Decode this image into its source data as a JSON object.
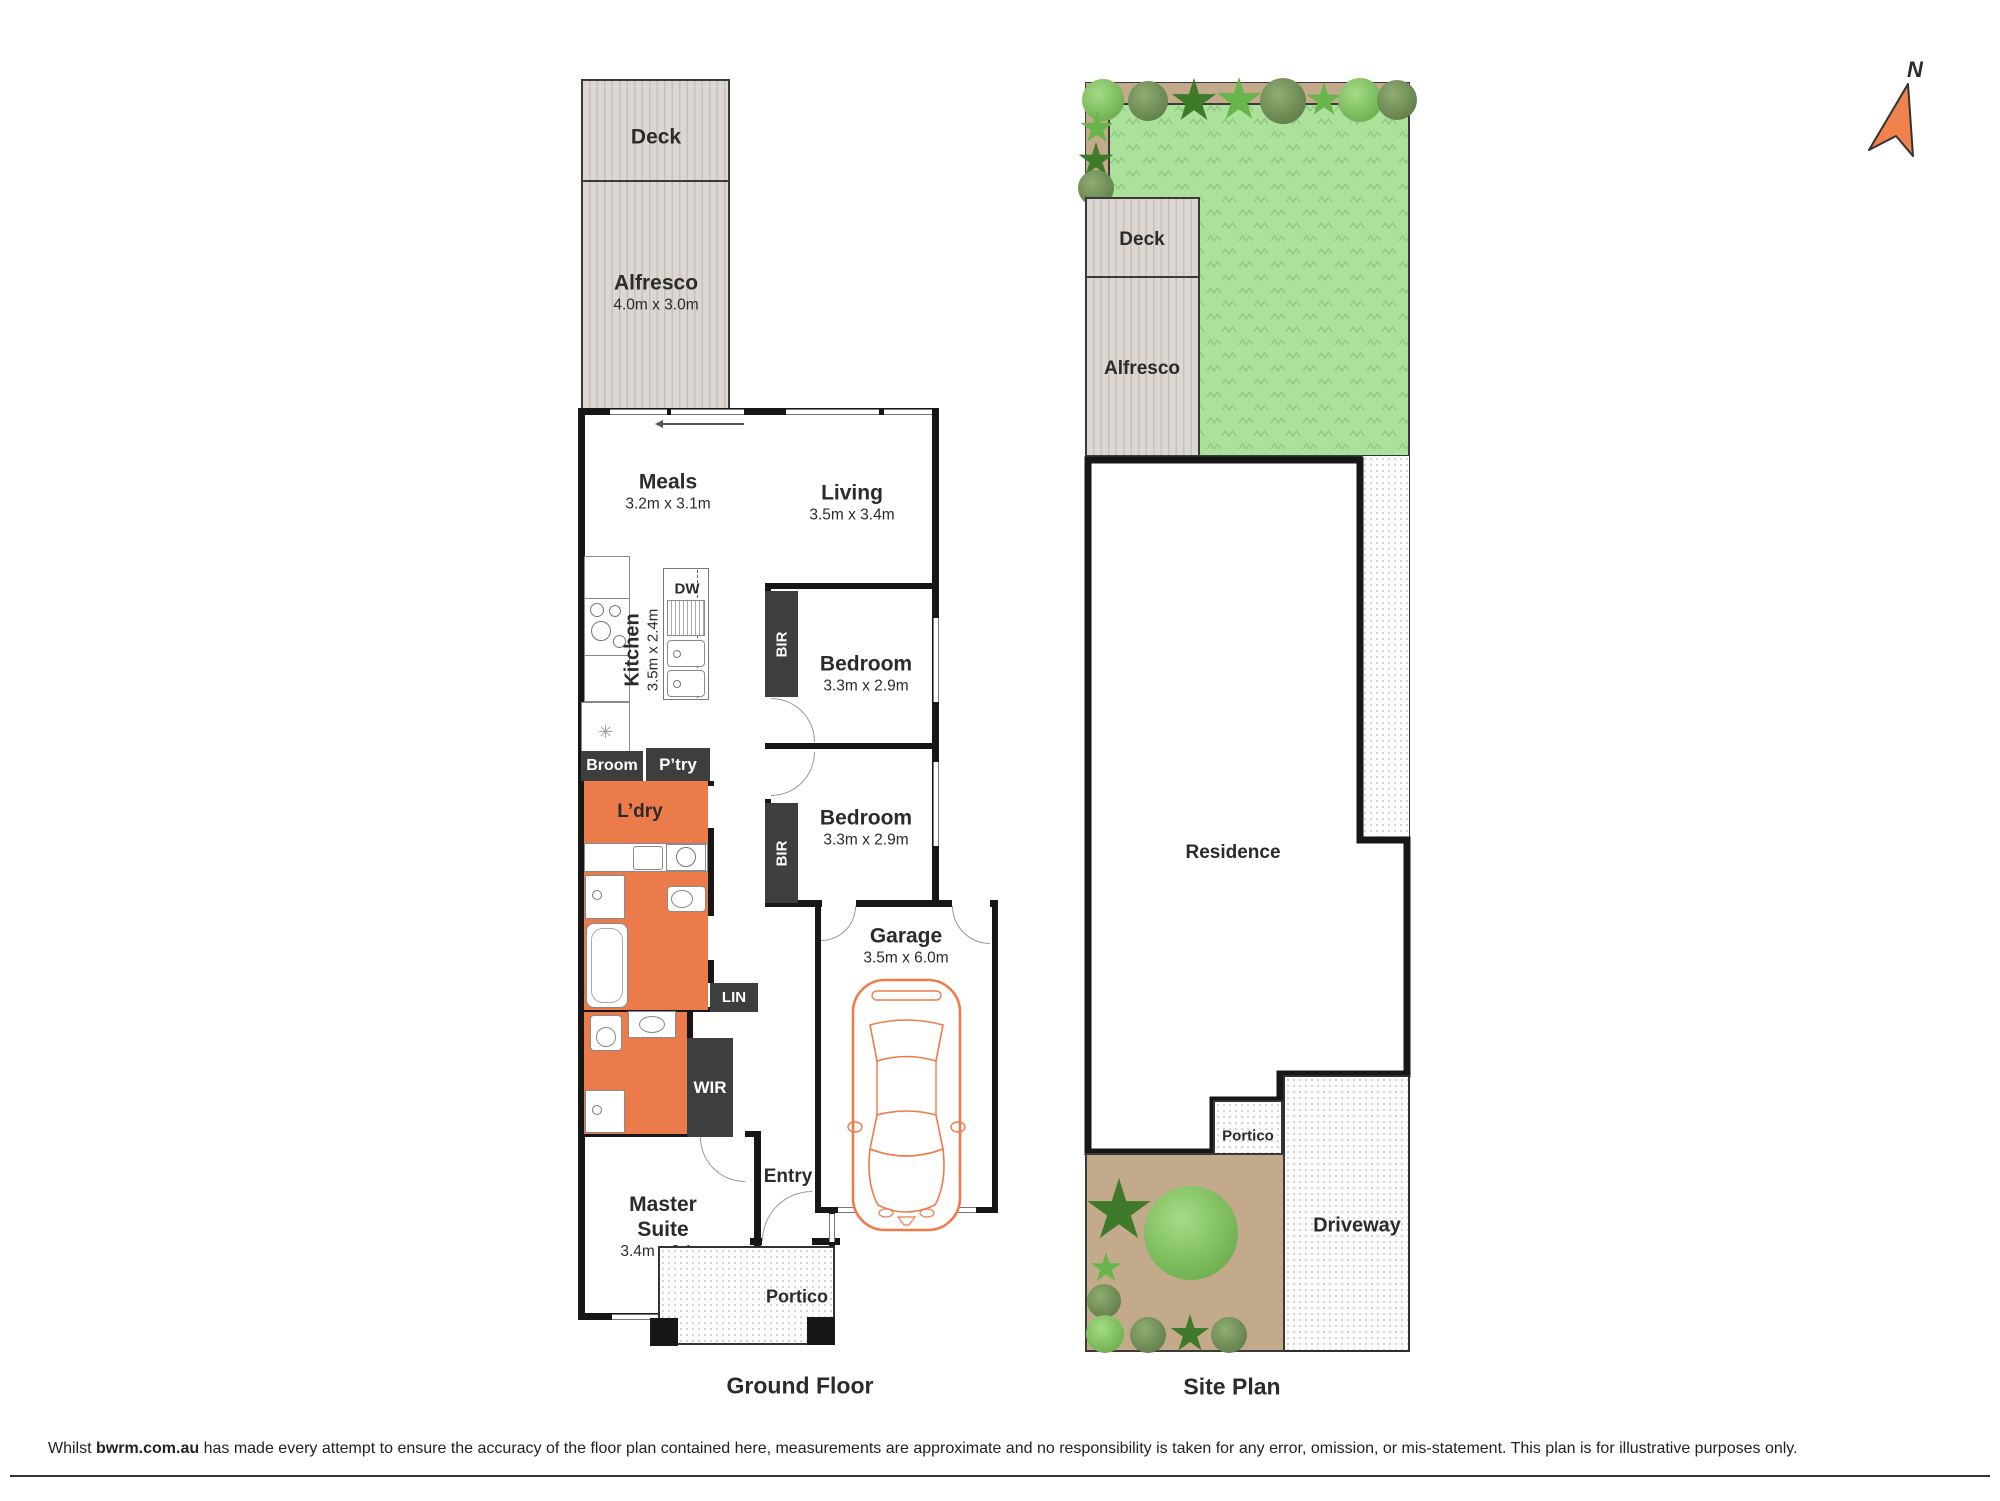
{
  "compass": {
    "label": "N"
  },
  "ground_floor": {
    "caption": "Ground Floor",
    "deck": {
      "label": "Deck"
    },
    "alfresco": {
      "label": "Alfresco",
      "dims": "4.0m x 3.0m"
    },
    "meals": {
      "label": "Meals",
      "dims": "3.2m x 3.1m"
    },
    "living": {
      "label": "Living",
      "dims": "3.5m x 3.4m"
    },
    "kitchen": {
      "label": "Kitchen",
      "dims": "3.5m x 2.4m"
    },
    "dishwasher": "DW",
    "bedroom1": {
      "label": "Bedroom",
      "dims": "3.3m x 2.9m",
      "robe": "BIR"
    },
    "bedroom2": {
      "label": "Bedroom",
      "dims": "3.3m x 2.9m",
      "robe": "BIR"
    },
    "broom": "Broom",
    "pantry": "P’try",
    "laundry": "L’dry",
    "garage": {
      "label": "Garage",
      "dims": "3.5m x 6.0m"
    },
    "linen": "LIN",
    "wir": "WIR",
    "entry": "Entry",
    "master": {
      "line1": "Master",
      "line2": "Suite",
      "dims": "3.4m x 3.1m"
    },
    "portico": "Portico"
  },
  "site_plan": {
    "caption": "Site Plan",
    "deck": "Deck",
    "alfresco": "Alfresco",
    "residence": "Residence",
    "portico": "Portico",
    "driveway": "Driveway"
  },
  "disclaimer": {
    "part1": "Whilst ",
    "brand": "bwrm.com.au",
    "part2": " has made every attempt to ensure the accuracy of the floor plan contained here, measurements are approximate and no responsibility is taken for any error, omission, or mis-statement. This plan is for illustrative purposes only."
  },
  "colors": {
    "accent_orange": "#ec7b4b",
    "wall_black": "#171717",
    "grass_green": "#ace19c",
    "garden_tan": "#c3aa8b",
    "compass_orange": "#f0824e"
  }
}
